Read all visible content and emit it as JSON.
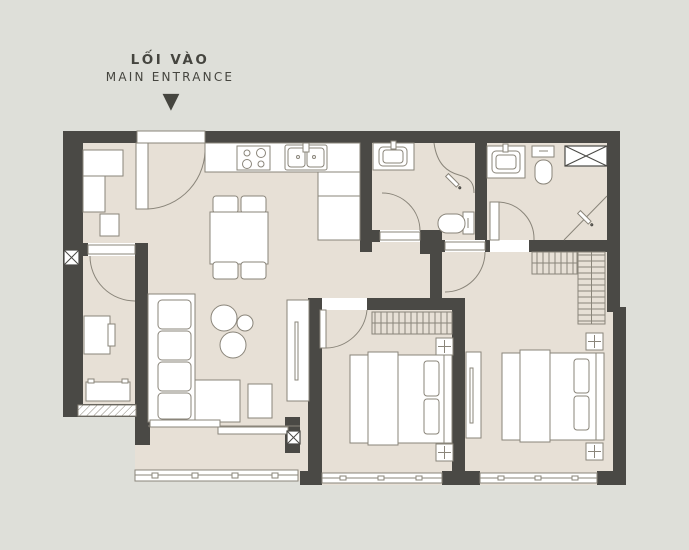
{
  "header": {
    "title_primary": "LỐI VÀO",
    "title_secondary": "MAIN ENTRANCE",
    "arrow_icon": "▼"
  },
  "palette": {
    "background": "#dedfd9",
    "floor": "#e7e0d6",
    "wall": "#4a4945",
    "line": "#8a857a",
    "furniture": "#ffffff",
    "text": "#45453f"
  }
}
